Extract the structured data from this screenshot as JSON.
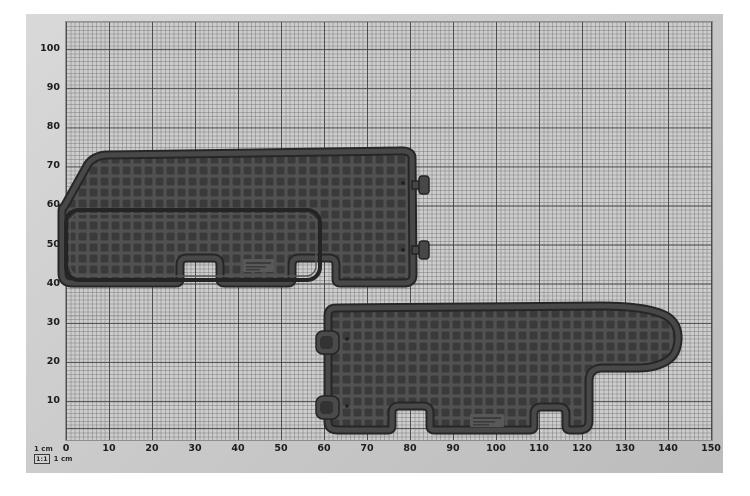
{
  "photo": {
    "subject": "two dark rubber vehicle floor mats photographed on centimetre graph paper"
  },
  "ruler": {
    "unit": "cm",
    "x_ticks": [
      "0",
      "10",
      "20",
      "30",
      "40",
      "50",
      "60",
      "70",
      "80",
      "90",
      "100",
      "110",
      "120",
      "130",
      "140",
      "150"
    ],
    "y_ticks": [
      "10",
      "20",
      "30",
      "40",
      "50",
      "60",
      "70",
      "80",
      "90",
      "100"
    ],
    "legend": {
      "unit_label": "1 cm",
      "scale_ratio": "1:1",
      "scale_unit": "1 cm"
    }
  },
  "objects": [
    {
      "name": "floor-mat-upper-left"
    },
    {
      "name": "floor-mat-lower-right"
    }
  ],
  "colors": {
    "photo_background": "#c9c9c9",
    "paper": "#cdcdcd",
    "grid_major": "#373737",
    "grid_minor": "#737373",
    "mat_base": "#3a3a3a",
    "mat_rib": "#515151",
    "mat_band": "#484848",
    "mat_outline": "#262626",
    "label_text": "#1c1c1c"
  }
}
